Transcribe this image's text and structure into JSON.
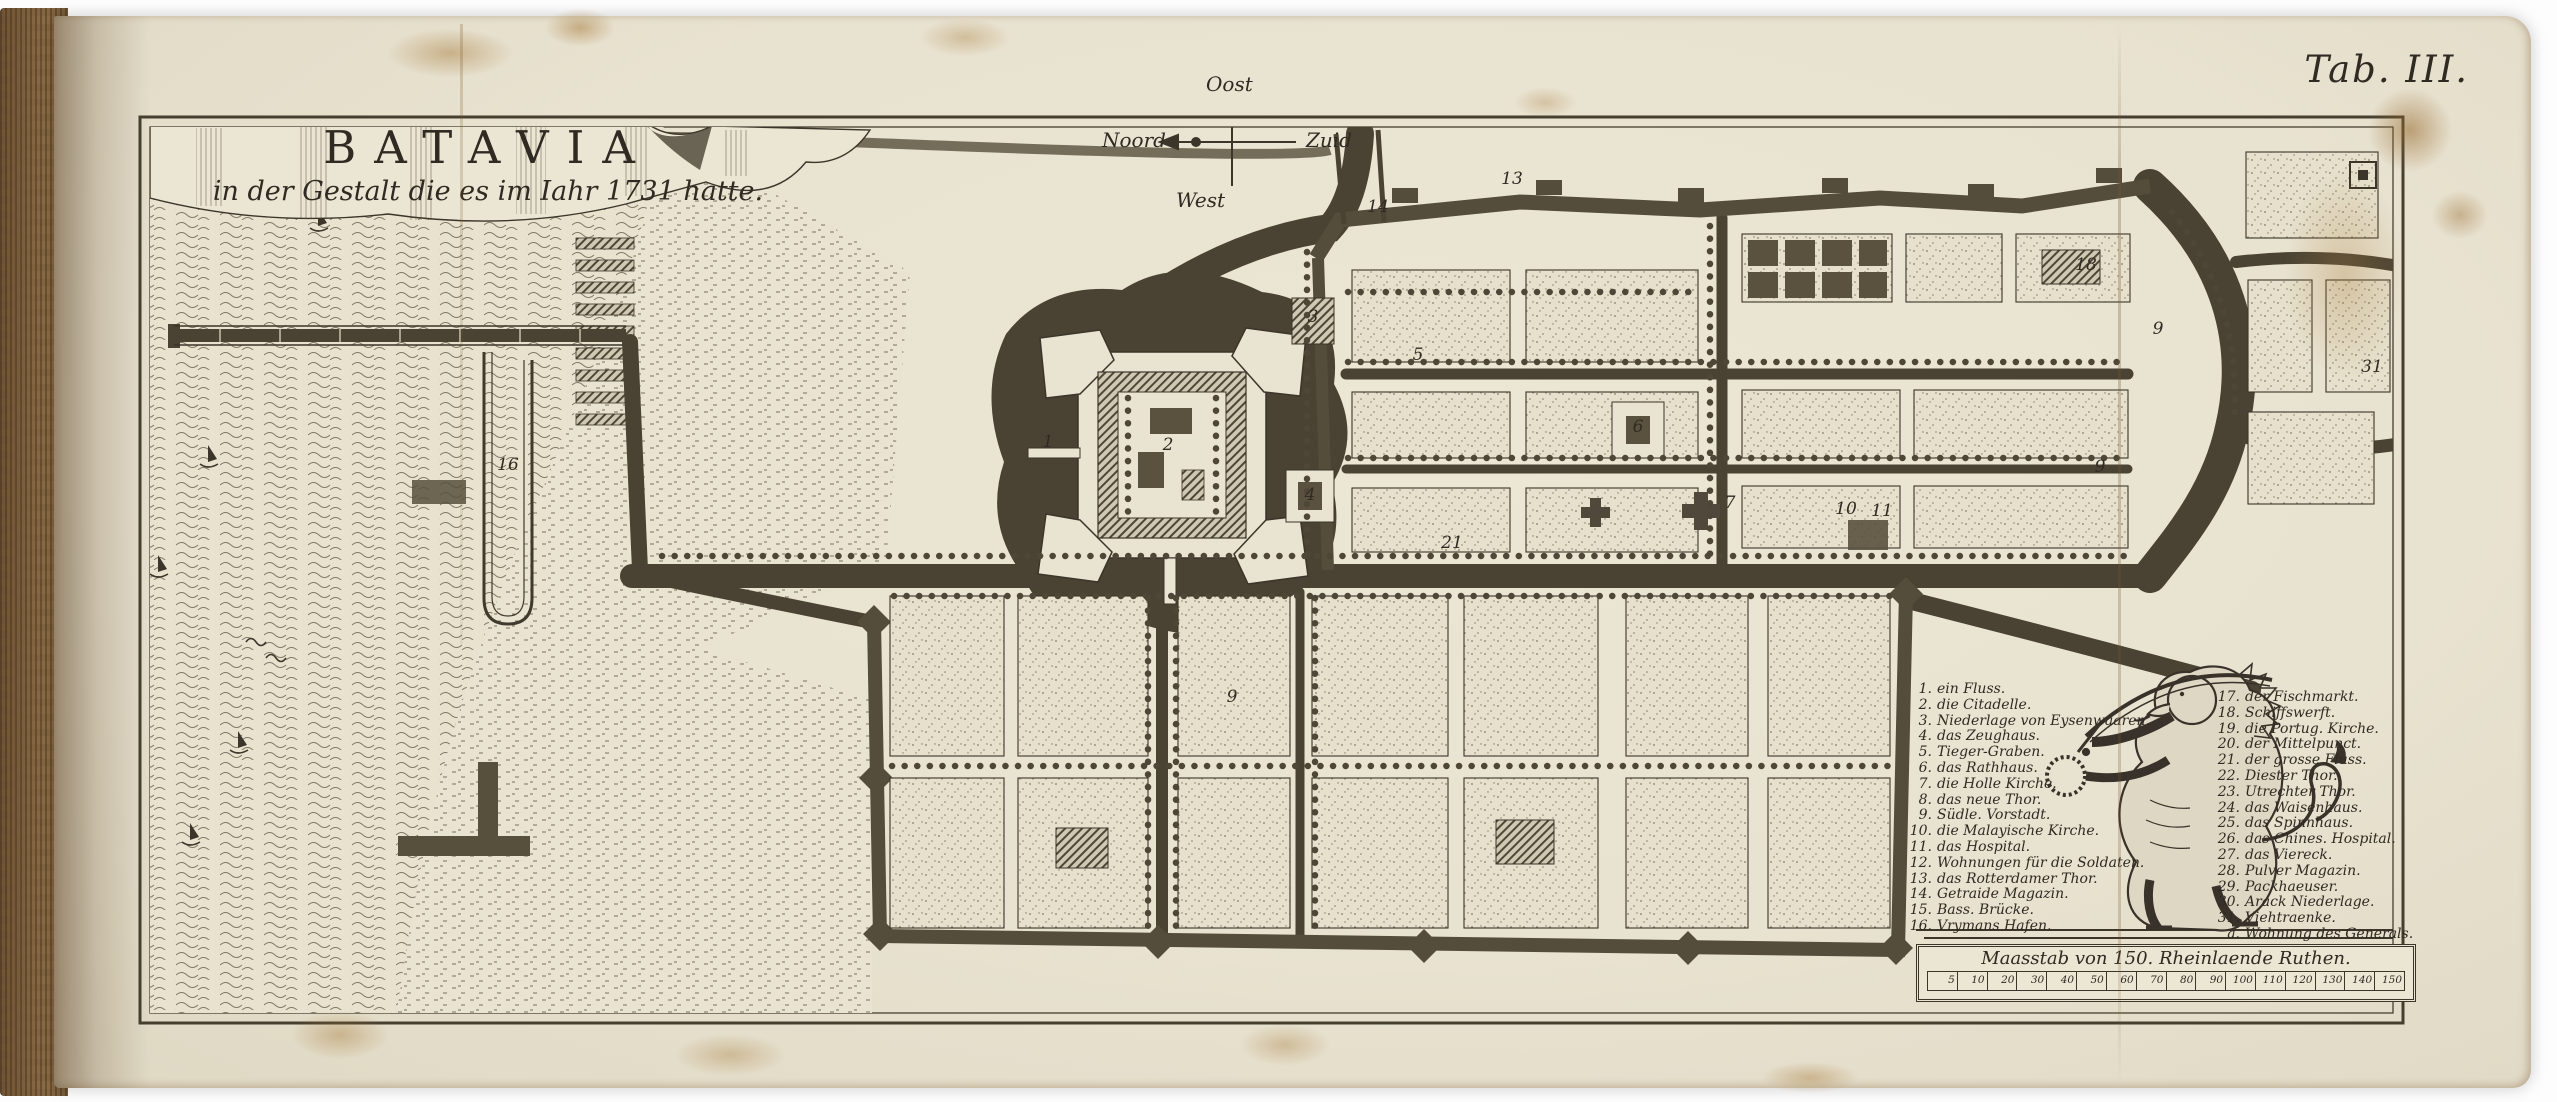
{
  "page": {
    "tab_label": "Tab. III."
  },
  "title": {
    "main": "BATAVIA",
    "sub": "in der Gestalt die es im Iahr 1731 hatte."
  },
  "compass": {
    "east": "Oost",
    "north": "Noord",
    "south": "Zuid",
    "west": "West"
  },
  "legend": {
    "left": [
      {
        "n": "1.",
        "label": "ein Fluss."
      },
      {
        "n": "2.",
        "label": "die Citadelle."
      },
      {
        "n": "3.",
        "label": "Niederlage von Eysenwaaren."
      },
      {
        "n": "4.",
        "label": "das Zeughaus."
      },
      {
        "n": "5.",
        "label": "Tieger-Graben."
      },
      {
        "n": "6.",
        "label": "das Rathhaus."
      },
      {
        "n": "7.",
        "label": "die Holle Kirche."
      },
      {
        "n": "8.",
        "label": "das neue Thor."
      },
      {
        "n": "9.",
        "label": "Südle. Vorstadt."
      },
      {
        "n": "10.",
        "label": "die Malayische Kirche."
      },
      {
        "n": "11.",
        "label": "das Hospital."
      },
      {
        "n": "12.",
        "label": "Wohnungen für die Soldaten."
      },
      {
        "n": "13.",
        "label": "das Rotterdamer Thor."
      },
      {
        "n": "14.",
        "label": "Getraide Magazin."
      },
      {
        "n": "15.",
        "label": "Bass. Brücke."
      },
      {
        "n": "16.",
        "label": "Vrymans Hafen."
      }
    ],
    "right": [
      {
        "n": "17.",
        "label": "der Fischmarkt."
      },
      {
        "n": "18.",
        "label": "Schiffswerft."
      },
      {
        "n": "19.",
        "label": "die Portug. Kirche."
      },
      {
        "n": "20.",
        "label": "der Mittelpunct."
      },
      {
        "n": "21.",
        "label": "der grosse Fluss."
      },
      {
        "n": "22.",
        "label": "Diester Thor."
      },
      {
        "n": "23.",
        "label": "Utrechter Thor."
      },
      {
        "n": "24.",
        "label": "das Waisenhaus."
      },
      {
        "n": "25.",
        "label": "das Spinnhaus."
      },
      {
        "n": "26.",
        "label": "das Chines. Hospital."
      },
      {
        "n": "27.",
        "label": "das Viereck."
      },
      {
        "n": "28.",
        "label": "Pulver Magazin."
      },
      {
        "n": "29.",
        "label": "Packhaeuser."
      },
      {
        "n": "30.",
        "label": "Arack Niederlage."
      },
      {
        "n": "31.",
        "label": "Viehtraenke."
      },
      {
        "n": "a.",
        "label": "Wohnung des Generals."
      }
    ]
  },
  "scale": {
    "label": "Maasstab von 150. Rheinlaende Ruthen.",
    "ticks": [
      "5",
      "10",
      "20",
      "30",
      "40",
      "50",
      "60",
      "70",
      "80",
      "90",
      "100",
      "110",
      "120",
      "130",
      "140",
      "150"
    ]
  },
  "map_markers": [
    {
      "n": "1",
      "x": 1048,
      "y": 447
    },
    {
      "n": "2",
      "x": 1168,
      "y": 450
    },
    {
      "n": "3",
      "x": 1313,
      "y": 322
    },
    {
      "n": "4",
      "x": 1310,
      "y": 500
    },
    {
      "n": "5",
      "x": 1418,
      "y": 360
    },
    {
      "n": "6",
      "x": 1638,
      "y": 432
    },
    {
      "n": "7",
      "x": 1730,
      "y": 508
    },
    {
      "n": "9",
      "x": 2158,
      "y": 334
    },
    {
      "n": "9",
      "x": 2100,
      "y": 472
    },
    {
      "n": "9",
      "x": 1232,
      "y": 702
    },
    {
      "n": "10",
      "x": 1846,
      "y": 514
    },
    {
      "n": "11",
      "x": 1882,
      "y": 516
    },
    {
      "n": "13",
      "x": 1512,
      "y": 184
    },
    {
      "n": "14",
      "x": 1378,
      "y": 212
    },
    {
      "n": "16",
      "x": 508,
      "y": 470
    },
    {
      "n": "18",
      "x": 2086,
      "y": 270
    },
    {
      "n": "21",
      "x": 1452,
      "y": 548
    },
    {
      "n": "31",
      "x": 2372,
      "y": 372
    }
  ],
  "colors": {
    "ink": "#3b352a",
    "paper": "#e9e3d1",
    "canal": "#4a4334",
    "stain": "#a87c42"
  }
}
